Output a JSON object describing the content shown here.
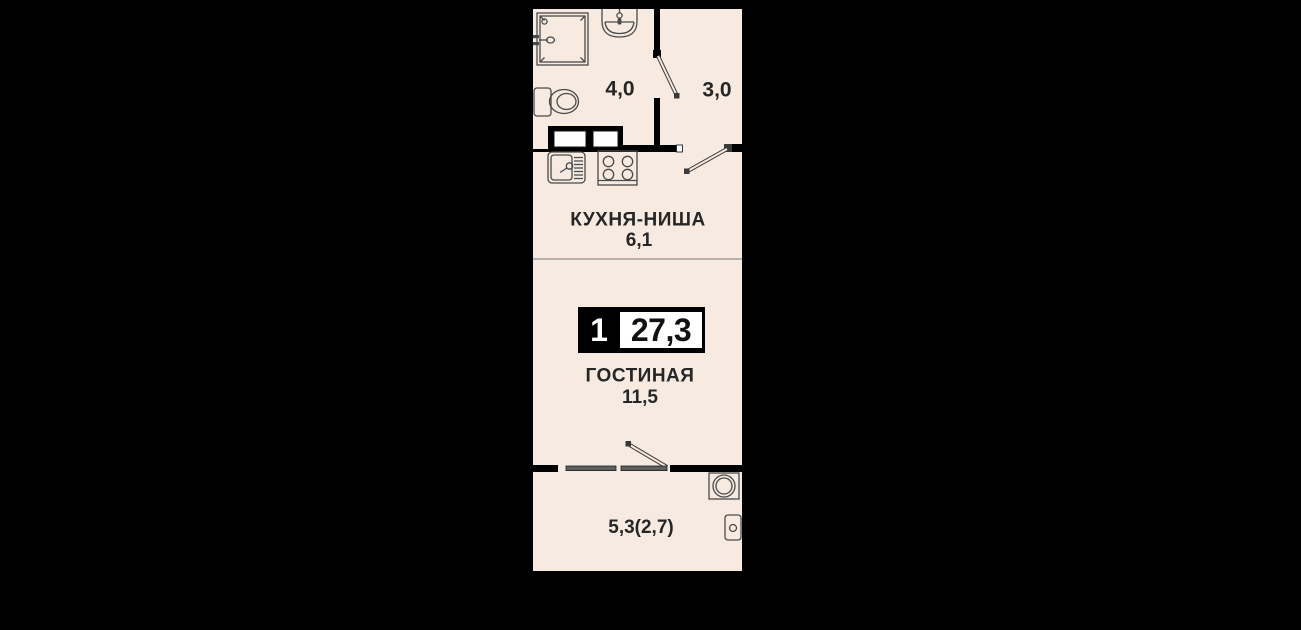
{
  "colors": {
    "background": "#000000",
    "floor": "#f7ebe1",
    "wall": "#000000",
    "fixture_outline": "#4a4a4a",
    "window_bar": "#5f5f5f",
    "zone_line": "#8d8d8d",
    "text": "#262626",
    "shaft_fill": "#ffffff",
    "badge_bg": "#000000",
    "badge_value_bg": "#ffffff"
  },
  "badge": {
    "rooms_count": "1",
    "total_area": "27,3"
  },
  "rooms": {
    "bathroom": {
      "area": "4,0"
    },
    "hallway": {
      "area": "3,0"
    },
    "kitchen": {
      "name": "КУХНЯ-НИША",
      "area": "6,1"
    },
    "living": {
      "name": "ГОСТИНАЯ",
      "area": "11,5"
    },
    "balcony": {
      "area": "5,3(2,7)"
    }
  }
}
